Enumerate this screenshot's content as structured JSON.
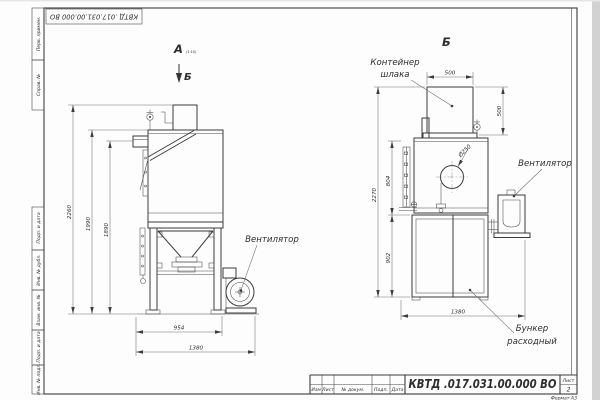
{
  "stamp": {
    "designation": "КВТД .017.031.00.000  ВО"
  },
  "margin": {
    "col1": "Перв. примен.",
    "col2": "Справ. №",
    "col3": "Подп. и дата",
    "col4": "Инв. № дубл.",
    "col5": "Взам. инв. №",
    "col6": "Подп. и дата",
    "col7": "Инв. № подл."
  },
  "title_block": {
    "izm": "Изм",
    "list": "Лист",
    "doc": "№ докум.",
    "podp": "Подп.",
    "data": "Дата",
    "designation": "КВТД .017.031.00.000  ВО",
    "sheet_label": "Лист",
    "sheet_number": "2",
    "format": "Формат А3"
  },
  "front_view": {
    "label": "А",
    "label_note": "(1:10)",
    "section_mark": "Б",
    "fan_label": "Вентилятор",
    "dim_h_total": "2260",
    "dim_h_body": "1990",
    "dim_h_stub": "1890",
    "dim_w_frame": "954",
    "dim_w_total": "1380"
  },
  "section_view": {
    "label": "Б",
    "container_line1": "Контейнер",
    "container_line2": "шлака",
    "fan_label": "Вентилятор",
    "hopper_line1": "Бункер",
    "hopper_line2": "расходный",
    "dim_top_width": "500",
    "dim_side_height": "500",
    "dim_diameter": "Ø250",
    "dim_h_total": "2270",
    "dim_h_mid": "804",
    "dim_h_bunker": "902",
    "dim_w_total": "1380"
  }
}
